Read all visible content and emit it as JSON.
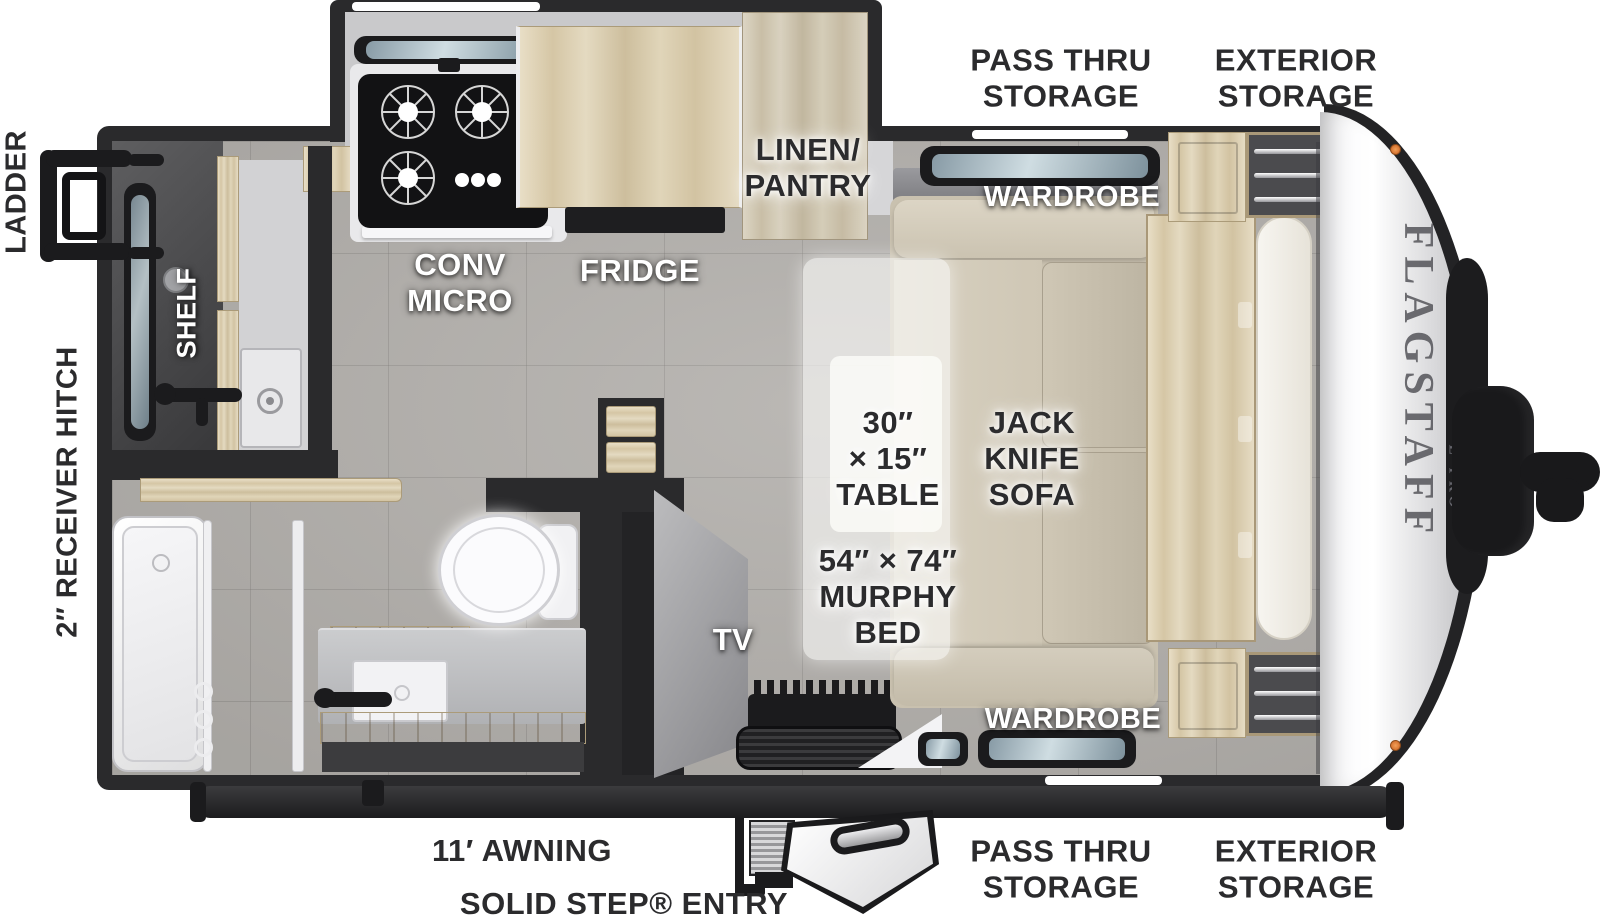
{
  "title": "Flagstaff E-Pro travel trailer floor plan",
  "exterior_labels": {
    "pass_thru_top": "PASS THRU\nSTORAGE",
    "exterior_top": "EXTERIOR\nSTORAGE",
    "pass_thru_bottom": "PASS THRU\nSTORAGE",
    "exterior_bottom": "EXTERIOR\nSTORAGE",
    "awning": "11′ AWNING",
    "entry": "SOLID STEP® ENTRY",
    "ladder": "LADDER",
    "receiver_hitch": "2″ RECEIVER HITCH"
  },
  "interior_labels": {
    "conv_micro": "CONV\nMICRO",
    "fridge": "FRIDGE",
    "linen_pantry": "LINEN/\nPANTRY",
    "shelf": "SHELF",
    "tv": "TV",
    "wardrobe_top": "WARDROBE",
    "wardrobe_bottom": "WARDROBE",
    "table": "30″\n× 15″\nTABLE",
    "murphy_bed": "54″ × 74″\nMURPHY\nBED",
    "jack_knife_sofa": "JACK\nKNIFE\nSOFA"
  },
  "branding": {
    "model": "FLAGSTAFF",
    "series": "E-PRO"
  },
  "colors": {
    "wall": "#2a2a2c",
    "floor_tile": "#b3b0ac",
    "wood": "#d8caa9",
    "sofa": "#cfc7b5",
    "label_dark": "#2b2b2d",
    "marker_light": "#e0762f"
  }
}
